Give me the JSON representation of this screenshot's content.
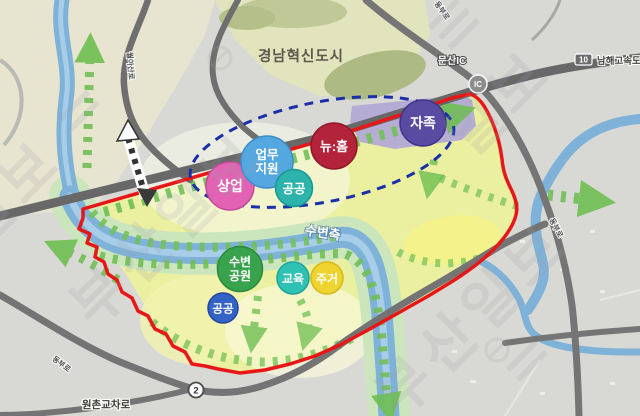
{
  "watermark": {
    "text": "부산일보",
    "text_short": "일보"
  },
  "region_labels": {
    "city": "경남혁신도시",
    "waterfront_axis": "수변축"
  },
  "roads": {
    "expressway_number": "10",
    "expressway_name": "남해고속도로",
    "ic_badge": "IC",
    "ic_name": "문산IC",
    "route2_badge": "2",
    "intersection_name": "원촌교차로",
    "road_label_northwest": "월아산로",
    "road_label_north": "동부로",
    "road_label_east": "동부로",
    "road_label_southwest": "동부로"
  },
  "zones": [
    {
      "name": "commercial",
      "label": "상업",
      "color": "#e263b3"
    },
    {
      "name": "business-support",
      "lines": [
        "업무",
        "지원"
      ],
      "color": "#55a7e0"
    },
    {
      "name": "public-upper",
      "label": "공공",
      "color": "#2db3ab"
    },
    {
      "name": "new-home",
      "label": "뉴:홈",
      "color": "#b3243a"
    },
    {
      "name": "self-sufficiency",
      "label": "자족",
      "color": "#594aa2"
    },
    {
      "name": "waterfront-park",
      "lines": [
        "수변",
        "공원"
      ],
      "color": "#39a24c"
    },
    {
      "name": "education",
      "label": "교육",
      "color": "#2fc2b4"
    },
    {
      "name": "residential",
      "label": "주거",
      "color": "#efd32f"
    },
    {
      "name": "public-lower",
      "label": "공공",
      "color": "#3363c4"
    }
  ],
  "colors": {
    "site_boundary": "#e81717",
    "planning_ellipse": "#1b2fa8",
    "green_axis": "#72bf55",
    "river": "#7fb2d9",
    "road": "#6e6e6e",
    "site_fill": "#ebefa0"
  }
}
